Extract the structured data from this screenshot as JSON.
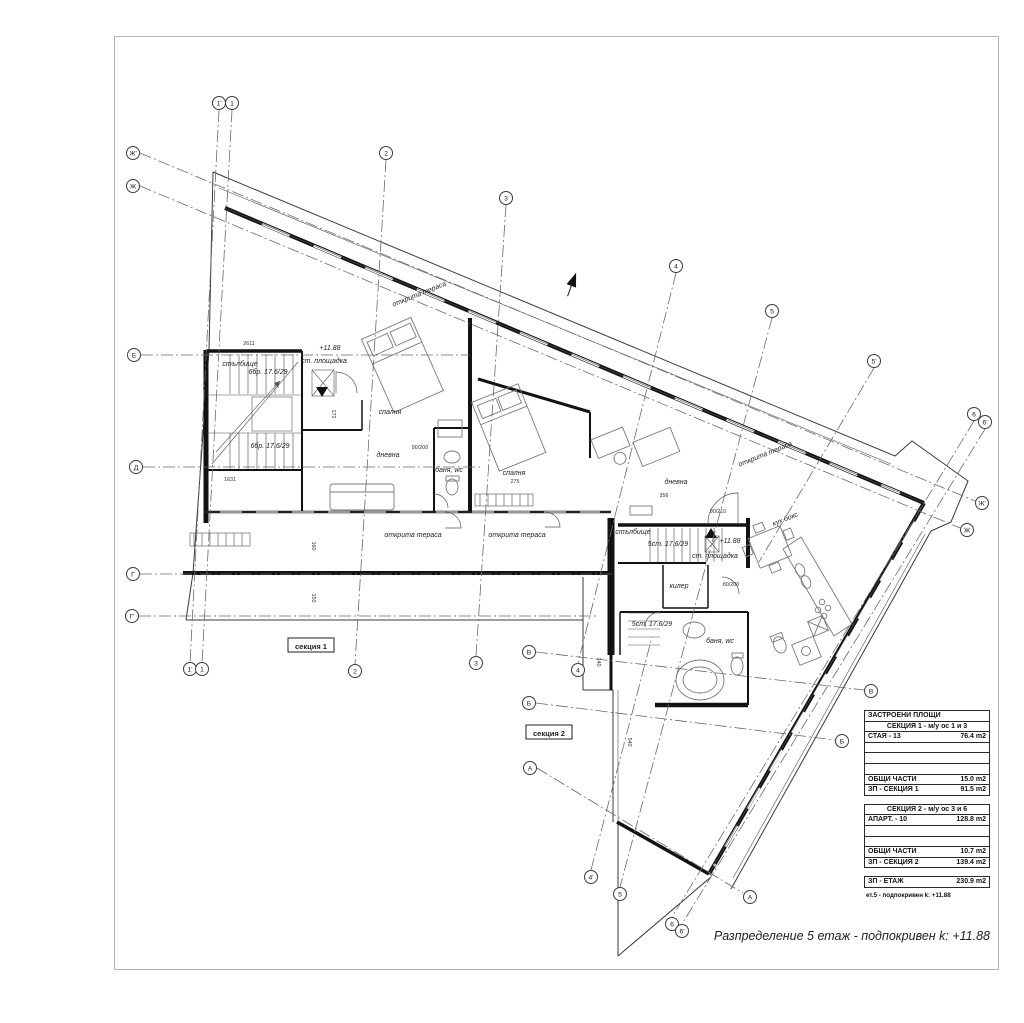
{
  "sheet": {
    "caption": "Разпределение 5 етаж - подпокривен  k: +11.88"
  },
  "plan": {
    "grid_markers": [
      {
        "label": "1'",
        "x": 219,
        "y": 103
      },
      {
        "label": "1",
        "x": 232,
        "y": 103
      },
      {
        "label": "2",
        "x": 386,
        "y": 153
      },
      {
        "label": "3",
        "x": 506,
        "y": 198
      },
      {
        "label": "4",
        "x": 676,
        "y": 266
      },
      {
        "label": "5",
        "x": 772,
        "y": 311
      },
      {
        "label": "5'",
        "x": 874,
        "y": 361
      },
      {
        "label": "6",
        "x": 974,
        "y": 414
      },
      {
        "label": "6'",
        "x": 985,
        "y": 422
      },
      {
        "label": "Ж'",
        "x": 133,
        "y": 153
      },
      {
        "label": "Ж",
        "x": 133,
        "y": 186
      },
      {
        "label": "Е",
        "x": 134,
        "y": 355
      },
      {
        "label": "Д",
        "x": 136,
        "y": 467
      },
      {
        "label": "Г",
        "x": 133,
        "y": 574
      },
      {
        "label": "Г'",
        "x": 132,
        "y": 616
      },
      {
        "label": "В",
        "x": 529,
        "y": 652
      },
      {
        "label": "Б",
        "x": 529,
        "y": 703
      },
      {
        "label": "А",
        "x": 530,
        "y": 768
      },
      {
        "label": "1'",
        "x": 190,
        "y": 669
      },
      {
        "label": "1",
        "x": 202,
        "y": 669
      },
      {
        "label": "2",
        "x": 355,
        "y": 671
      },
      {
        "label": "3",
        "x": 476,
        "y": 663
      },
      {
        "label": "4",
        "x": 578,
        "y": 670
      },
      {
        "label": "4'",
        "x": 591,
        "y": 877
      },
      {
        "label": "5",
        "x": 620,
        "y": 894
      },
      {
        "label": "6",
        "x": 672,
        "y": 924
      },
      {
        "label": "6'",
        "x": 682,
        "y": 931
      },
      {
        "label": "А",
        "x": 750,
        "y": 897
      },
      {
        "label": "Б",
        "x": 842,
        "y": 741
      },
      {
        "label": "В",
        "x": 871,
        "y": 691
      },
      {
        "label": "Ж",
        "x": 967,
        "y": 530
      },
      {
        "label": "Ж'",
        "x": 982,
        "y": 503
      }
    ],
    "grid_lines": [
      {
        "x1": 219,
        "y1": 110,
        "x2": 190,
        "y2": 663
      },
      {
        "x1": 232,
        "y1": 110,
        "x2": 202,
        "y2": 663
      },
      {
        "x1": 386,
        "y1": 160,
        "x2": 355,
        "y2": 664
      },
      {
        "x1": 506,
        "y1": 205,
        "x2": 476,
        "y2": 656
      },
      {
        "x1": 676,
        "y1": 273,
        "x2": 578,
        "y2": 663
      },
      {
        "x1": 591,
        "y1": 870,
        "x2": 652,
        "y2": 637
      },
      {
        "x1": 772,
        "y1": 318,
        "x2": 620,
        "y2": 887
      },
      {
        "x1": 874,
        "y1": 368,
        "x2": 759,
        "y2": 562
      },
      {
        "x1": 974,
        "y1": 421,
        "x2": 672,
        "y2": 917
      },
      {
        "x1": 985,
        "y1": 429,
        "x2": 682,
        "y2": 924
      },
      {
        "x1": 140,
        "y1": 153,
        "x2": 975,
        "y2": 501
      },
      {
        "x1": 140,
        "y1": 186,
        "x2": 960,
        "y2": 528
      },
      {
        "x1": 141,
        "y1": 355,
        "x2": 470,
        "y2": 355
      },
      {
        "x1": 143,
        "y1": 467,
        "x2": 480,
        "y2": 467
      },
      {
        "x1": 140,
        "y1": 574,
        "x2": 612,
        "y2": 574
      },
      {
        "x1": 139,
        "y1": 616,
        "x2": 598,
        "y2": 616
      },
      {
        "x1": 536,
        "y1": 652,
        "x2": 864,
        "y2": 690
      },
      {
        "x1": 536,
        "y1": 703,
        "x2": 835,
        "y2": 740
      },
      {
        "x1": 537,
        "y1": 768,
        "x2": 743,
        "y2": 893
      }
    ],
    "room_labels": [
      {
        "text": "открита тераса",
        "x": 420,
        "y": 296,
        "rot": -22
      },
      {
        "text": "открита тераса",
        "x": 766,
        "y": 456,
        "rot": -22
      },
      {
        "text": "открита тераса",
        "x": 413,
        "y": 537,
        "rot": 0
      },
      {
        "text": "открита тераса",
        "x": 517,
        "y": 537,
        "rot": 0
      },
      {
        "text": "стълбище",
        "x": 240,
        "y": 366,
        "rot": 0
      },
      {
        "text": "ст. площадка",
        "x": 324,
        "y": 363,
        "rot": 0
      },
      {
        "text": "+11.88",
        "x": 330,
        "y": 350,
        "rot": 0
      },
      {
        "text": "спалня",
        "x": 390,
        "y": 414,
        "rot": 0
      },
      {
        "text": "дневна",
        "x": 388,
        "y": 457,
        "rot": 0
      },
      {
        "text": "баня, wc",
        "x": 449,
        "y": 472,
        "rot": 0
      },
      {
        "text": "спалня",
        "x": 514,
        "y": 475,
        "rot": 0
      },
      {
        "text": "дневна",
        "x": 676,
        "y": 484,
        "rot": 0
      },
      {
        "text": "стълбище",
        "x": 633,
        "y": 534,
        "rot": 0
      },
      {
        "text": "ст. площадка",
        "x": 715,
        "y": 558,
        "rot": 0
      },
      {
        "text": "+11.88",
        "x": 730,
        "y": 543,
        "rot": 0
      },
      {
        "text": "кух.бокс",
        "x": 786,
        "y": 521,
        "rot": -22
      },
      {
        "text": "килер",
        "x": 679,
        "y": 588,
        "rot": 0
      },
      {
        "text": "баня, wc",
        "x": 720,
        "y": 643,
        "rot": 0
      },
      {
        "text": "6бр. 17.6/29",
        "x": 268,
        "y": 374,
        "rot": 0
      },
      {
        "text": "6бр. 17.6/29",
        "x": 270,
        "y": 448,
        "rot": 0
      },
      {
        "text": "5ст. 17.6/29",
        "x": 668,
        "y": 546,
        "rot": 0
      },
      {
        "text": "5ст. 17.6/29",
        "x": 652,
        "y": 626,
        "rot": 0
      }
    ],
    "dims": [
      {
        "text": "2611",
        "x": 249,
        "y": 345,
        "rot": 0
      },
      {
        "text": "1631",
        "x": 230,
        "y": 481,
        "rot": 0
      },
      {
        "text": "275",
        "x": 515,
        "y": 483,
        "rot": 0
      },
      {
        "text": "356",
        "x": 664,
        "y": 497,
        "rot": 0
      },
      {
        "text": "172",
        "x": 332,
        "y": 414,
        "rot": 90
      },
      {
        "text": "160",
        "x": 312,
        "y": 546,
        "rot": 90
      },
      {
        "text": "150",
        "x": 312,
        "y": 598,
        "rot": 90
      },
      {
        "text": "540",
        "x": 628,
        "y": 742,
        "rot": 90
      },
      {
        "text": "140",
        "x": 597,
        "y": 662,
        "rot": 90
      },
      {
        "text": "90/210",
        "x": 718,
        "y": 513,
        "rot": 0
      },
      {
        "text": "80/200",
        "x": 731,
        "y": 586,
        "rot": 0
      },
      {
        "text": "90/200",
        "x": 420,
        "y": 449,
        "rot": 0
      }
    ],
    "section_tags": [
      {
        "text": "секция 1",
        "x": 311,
        "y": 646
      },
      {
        "text": "секция 2",
        "x": 549,
        "y": 733
      }
    ]
  },
  "areas_table": {
    "header": "ЗАСТРОЕНИ ПЛОЩИ",
    "sections": [
      {
        "title": "СЕКЦИЯ 1 - м/у ос 1 и 3",
        "rows": [
          [
            "СТАЯ - 13",
            "76.4 m2"
          ],
          [
            "",
            ""
          ],
          [
            "",
            ""
          ],
          [
            "",
            ""
          ],
          [
            "ОБЩИ ЧАСТИ",
            "15.0 m2"
          ],
          [
            "ЗП - СЕКЦИЯ 1",
            "91.5 m2"
          ]
        ]
      },
      {
        "title": "СЕКЦИЯ 2 - м/у ос 3 и 6",
        "rows": [
          [
            "АПАРТ. - 10",
            "128.8 m2"
          ],
          [
            "",
            ""
          ],
          [
            "",
            ""
          ],
          [
            "ОБЩИ ЧАСТИ",
            "10.7 m2"
          ],
          [
            "ЗП - СЕКЦИЯ 2",
            "139.4 m2"
          ]
        ]
      }
    ],
    "total": [
      "ЗП - ЕТАЖ",
      "230.9 m2"
    ],
    "footnote": "ет.5 - подпокривен  k: +11.88"
  }
}
